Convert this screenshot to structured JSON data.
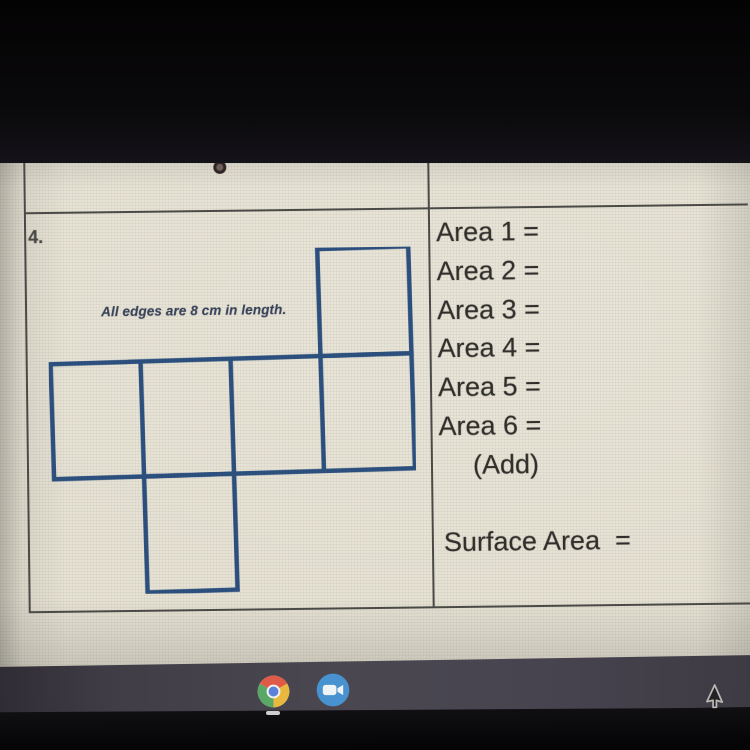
{
  "worksheet": {
    "question_number": "4.",
    "figure_note": "All edges are 8 cm in length.",
    "area_labels": [
      "Area 1 =",
      "Area 2 =",
      "Area 3 =",
      "Area 4 =",
      "Area 5 =",
      "Area 6 ="
    ],
    "add_label": "(Add)",
    "surface_area_label": "Surface Area  ="
  },
  "figure": {
    "type": "cube-net",
    "square_count": 6,
    "edge_length": "8 cm"
  },
  "taskbar": {
    "icons": [
      {
        "name": "chrome"
      },
      {
        "name": "zoom"
      }
    ]
  },
  "colors": {
    "net_stroke": "#2b5080",
    "sheet": "#e6e2d4",
    "shelf": "#474450",
    "chrome_red": "#e05a48",
    "chrome_yellow": "#e8b93e",
    "chrome_green": "#5aa865",
    "chrome_blue": "#5b82d8",
    "chrome_white": "#f2f1ee",
    "zoom_blue": "#4792cf",
    "zoom_white": "#eef3f6"
  }
}
